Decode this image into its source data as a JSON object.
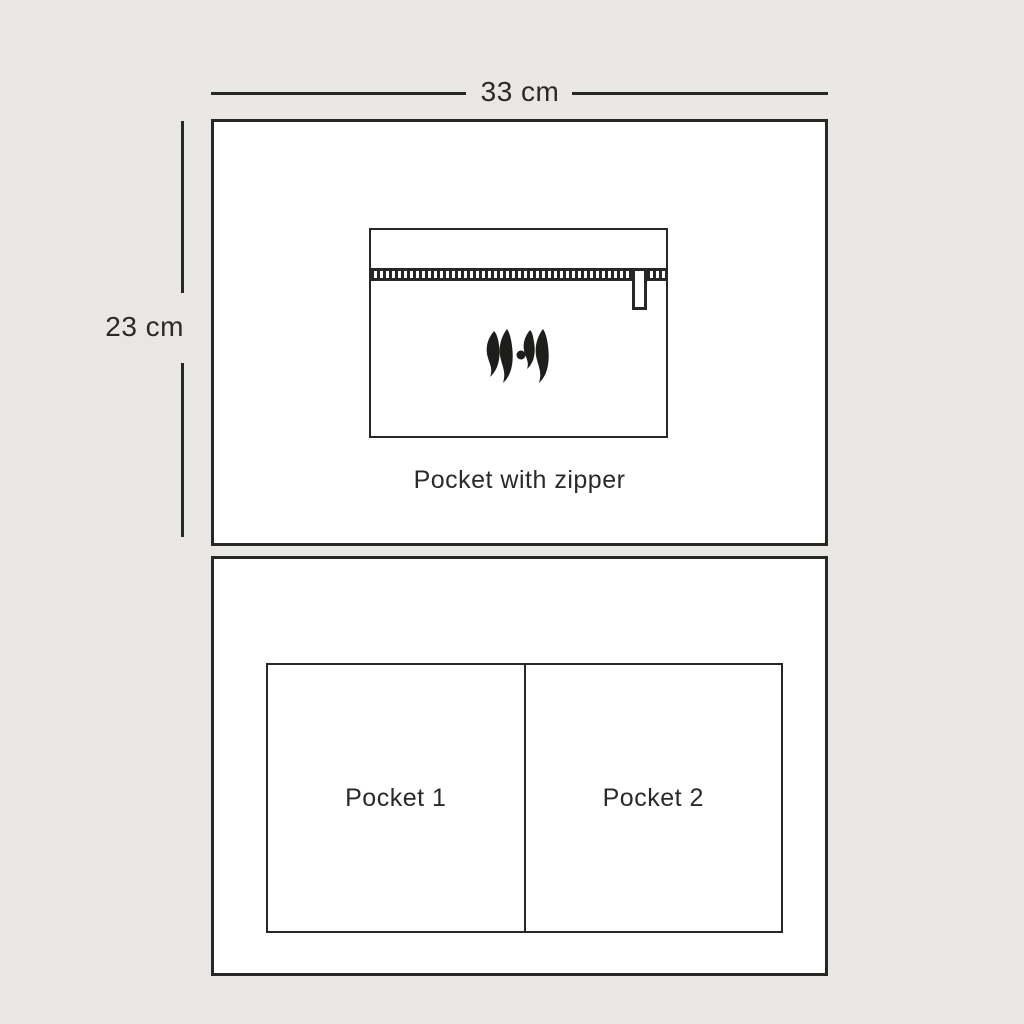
{
  "page": {
    "background_color": "#e8e7e4",
    "line_color": "#272725",
    "text_color": "#2b2a28"
  },
  "dimension_labels": {
    "width": "33 cm",
    "height": "23 cm"
  },
  "front_panel": {
    "caption": "Pocket with zipper",
    "logo_name": "brand-monogram"
  },
  "back_panel": {
    "pockets": [
      {
        "label": "Pocket 1"
      },
      {
        "label": "Pocket 2"
      }
    ]
  }
}
